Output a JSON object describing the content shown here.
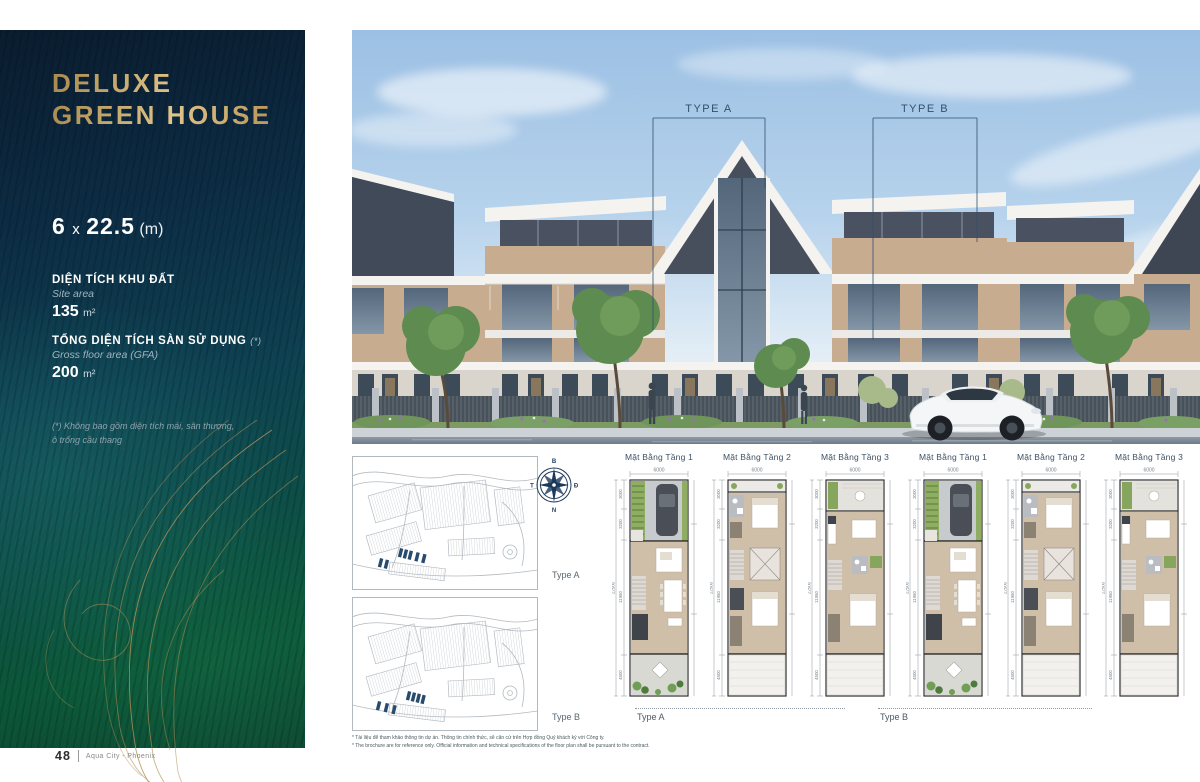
{
  "page": {
    "number": "48",
    "brand": "Aqua City - Phoenix"
  },
  "sidebar": {
    "title_line1": "DELUXE",
    "title_line2": "GREEN HOUSE",
    "dimensions": {
      "width": "6",
      "sep": "x",
      "depth": "22.5",
      "unit": "(m)"
    },
    "site_area": {
      "label_vi": "DIỆN TÍCH KHU ĐẤT",
      "label_en": "Site area",
      "value": "135",
      "unit": "m²"
    },
    "gfa": {
      "label_vi": "TỔNG DIỆN TÍCH SÀN SỬ DỤNG",
      "note": "(*)",
      "label_en": "Gross floor area (GFA)",
      "value": "200",
      "unit": "m²"
    },
    "footnote_line1": "(*) Không bao gồm diện tích mái, sân thượng,",
    "footnote_line2": "ô trống cầu thang"
  },
  "render": {
    "type_a_label": "TYPE A",
    "type_b_label": "TYPE B"
  },
  "compass": {
    "north": "B",
    "east": "Đ",
    "south": "N",
    "west": "T"
  },
  "site_maps": [
    {
      "label": "Type A"
    },
    {
      "label": "Type B"
    }
  ],
  "floor_plans": {
    "width_dim": "6000",
    "overall_dim": "22500",
    "left_dims": [
      "3000",
      "3200",
      "11950",
      "4500"
    ],
    "items": [
      {
        "label": "Mặt Bằng Tầng 1",
        "variant": "f1"
      },
      {
        "label": "Mặt Bằng Tầng 2",
        "variant": "f2"
      },
      {
        "label": "Mặt Bằng Tầng 3",
        "variant": "f3"
      },
      {
        "label": "Mặt Bằng Tầng 1",
        "variant": "f1"
      },
      {
        "label": "Mặt Bằng Tầng 2",
        "variant": "f2"
      },
      {
        "label": "Mặt Bằng Tầng 3",
        "variant": "f3"
      }
    ],
    "group_labels": [
      "Type A",
      "Type B"
    ]
  },
  "footnotes": {
    "vi": "* Tài liệu để tham khảo thông tin dự án. Thông tin chính thức, sẽ căn cứ trên Hợp đồng Quý khách ký với Công ty.",
    "en": "* The brochure are for reference only. Official information and technical specifications of the floor plan shall be pursuant to the contract."
  }
}
